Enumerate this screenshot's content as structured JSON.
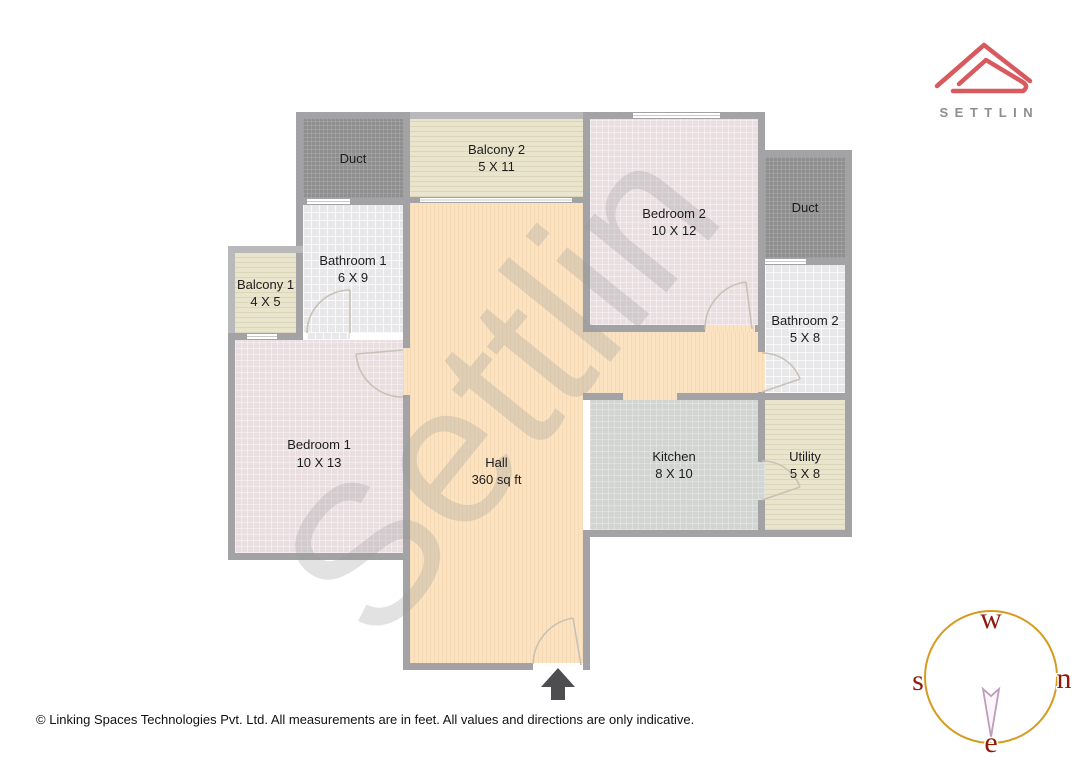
{
  "brand": {
    "name": "SETTLIN",
    "logo_color": "#d85a5e",
    "name_color": "#8e8e8e"
  },
  "floorplan": {
    "watermark": "Settlin",
    "rooms": {
      "duct_1": {
        "label": "Duct",
        "dims": ""
      },
      "balcony_2": {
        "label": "Balcony 2",
        "dims": "5 X 11"
      },
      "bedroom_2": {
        "label": "Bedroom 2",
        "dims": "10 X 12"
      },
      "duct_2": {
        "label": "Duct",
        "dims": ""
      },
      "bathroom_2": {
        "label": "Bathroom 2",
        "dims": "5 X 8"
      },
      "utility": {
        "label": "Utility",
        "dims": "5 X 8"
      },
      "kitchen": {
        "label": "Kitchen",
        "dims": "8 X 10"
      },
      "bathroom_1": {
        "label": "Bathroom 1",
        "dims": "6 X 9"
      },
      "balcony_1": {
        "label": "Balcony 1",
        "dims": "4 X 5"
      },
      "bedroom_1": {
        "label": "Bedroom 1",
        "dims": "10 X 13"
      },
      "hall": {
        "label": "Hall",
        "dims": "360 sq ft"
      }
    },
    "wall_color": "#a3a3a5",
    "hall_floor_color": "#fbe3c2"
  },
  "compass": {
    "top": "w",
    "right": "n",
    "left": "s",
    "bottom": "e",
    "circle_color": "#d49c1e",
    "letter_color": "#8e1a0b",
    "needle_color": "#bd9dbb"
  },
  "footer": {
    "disclaimer": "© Linking Spaces Technologies Pvt. Ltd. All measurements are in feet. All values and directions are only indicative."
  }
}
